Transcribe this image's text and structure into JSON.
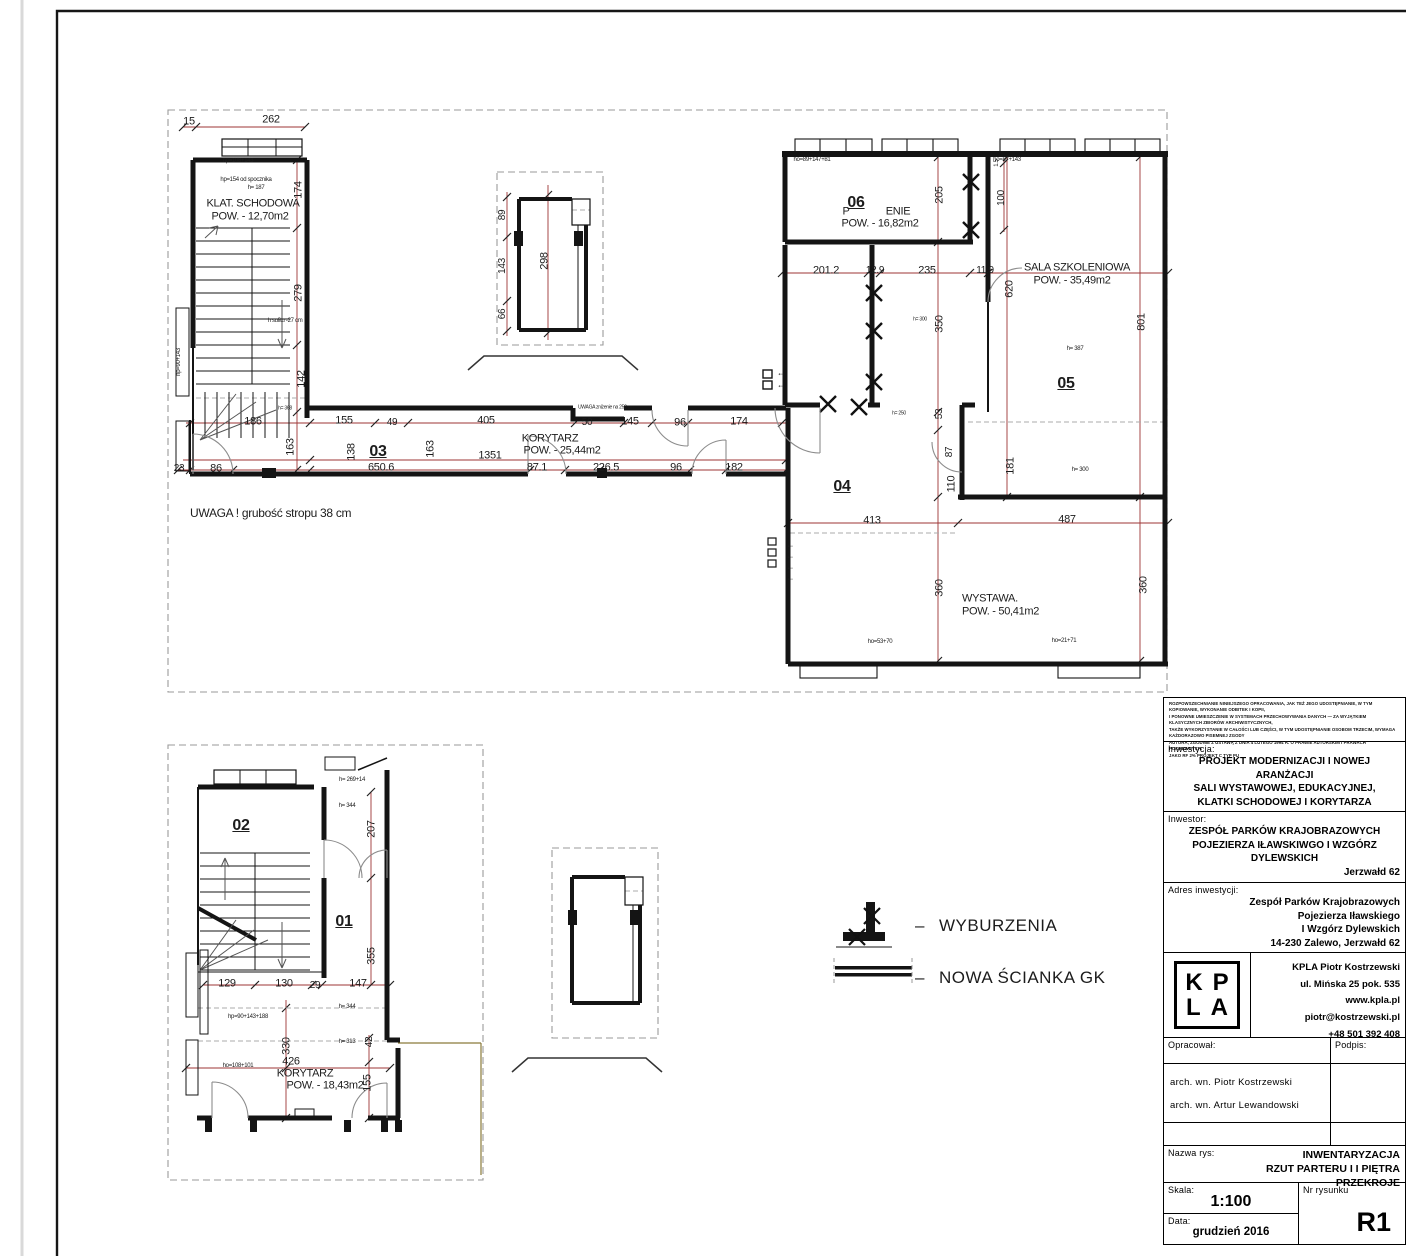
{
  "labels": [
    {
      "t": "15",
      "x": 189,
      "y": 122
    },
    {
      "t": "262",
      "x": 271,
      "y": 120
    },
    {
      "t": "174",
      "x": 299,
      "y": 190,
      "r": 1
    },
    {
      "t": "279",
      "x": 299,
      "y": 293,
      "r": 1
    },
    {
      "t": "142",
      "x": 302,
      "y": 379,
      "r": 1
    },
    {
      "t": "KLAT. SCHODOWA",
      "x": 253,
      "y": 204
    },
    {
      "t": "POW. - 12,70m2",
      "x": 250,
      "y": 217
    },
    {
      "t": "hp=108+143",
      "x": 238,
      "y": 161,
      "s": 6
    },
    {
      "t": "hp=154 od spocznika",
      "x": 246,
      "y": 180,
      "s": 6
    },
    {
      "t": "h= 187",
      "x": 256,
      "y": 188,
      "s": 6
    },
    {
      "t": "h sufitu -27 cm",
      "x": 285,
      "y": 321,
      "s": 6
    },
    {
      "t": "hp=90+143",
      "x": 179,
      "y": 362,
      "s": 6,
      "r": 1
    },
    {
      "t": "h= 368",
      "x": 285,
      "y": 409,
      "s": 5
    },
    {
      "t": "186",
      "x": 253,
      "y": 422
    },
    {
      "t": "155",
      "x": 344,
      "y": 421
    },
    {
      "t": "49",
      "x": 392,
      "y": 423,
      "s": 10
    },
    {
      "t": "405",
      "x": 486,
      "y": 421
    },
    {
      "t": "50",
      "x": 587,
      "y": 423,
      "s": 10
    },
    {
      "t": "145",
      "x": 630,
      "y": 422
    },
    {
      "t": "96",
      "x": 680,
      "y": 423
    },
    {
      "t": "174",
      "x": 739,
      "y": 422
    },
    {
      "t": "UWAGA  zniżenie na 250 cm",
      "x": 578,
      "y": 408,
      "s": 5,
      "al": "left"
    },
    {
      "t": "163",
      "x": 291,
      "y": 447,
      "r": 1
    },
    {
      "t": "138",
      "x": 352,
      "y": 452,
      "r": 1
    },
    {
      "t": "03",
      "x": 378,
      "y": 452,
      "s": 16,
      "w": 1,
      "u": 1
    },
    {
      "t": "650.6",
      "x": 381,
      "y": 468
    },
    {
      "t": "163",
      "x": 431,
      "y": 449,
      "r": 1
    },
    {
      "t": "1351",
      "x": 490,
      "y": 456
    },
    {
      "t": "KORYTARZ",
      "x": 550,
      "y": 439
    },
    {
      "t": "POW. - 25,44m2",
      "x": 562,
      "y": 451
    },
    {
      "t": "87.1",
      "x": 537,
      "y": 468
    },
    {
      "t": "226.5",
      "x": 606,
      "y": 468
    },
    {
      "t": "96",
      "x": 676,
      "y": 468
    },
    {
      "t": "182",
      "x": 734,
      "y": 468
    },
    {
      "t": "23",
      "x": 179,
      "y": 469,
      "s": 10
    },
    {
      "t": "86",
      "x": 216,
      "y": 469
    },
    {
      "t": "06",
      "x": 856,
      "y": 203,
      "s": 16,
      "w": 1,
      "u": 1
    },
    {
      "t": "P",
      "x": 846,
      "y": 212
    },
    {
      "t": "ENIE",
      "x": 898,
      "y": 212
    },
    {
      "t": "POW. - 16,82m2",
      "x": 880,
      "y": 224
    },
    {
      "t": "205",
      "x": 940,
      "y": 195,
      "r": 1
    },
    {
      "t": "1.5",
      "x": 997,
      "y": 163,
      "r": 1,
      "s": 6
    },
    {
      "t": "100",
      "x": 1002,
      "y": 198,
      "r": 1,
      "s": 10
    },
    {
      "t": "ho=89+147+81",
      "x": 812,
      "y": 160,
      "s": 6
    },
    {
      "t": "ho=87+143",
      "x": 1007,
      "y": 160,
      "s": 6
    },
    {
      "t": "201.2",
      "x": 826,
      "y": 271
    },
    {
      "t": "12.9",
      "x": 875,
      "y": 271,
      "s": 10
    },
    {
      "t": "235",
      "x": 927,
      "y": 271
    },
    {
      "t": "11.9",
      "x": 985,
      "y": 271,
      "s": 10
    },
    {
      "t": "620",
      "x": 1010,
      "y": 289,
      "r": 1
    },
    {
      "t": "SALA SZKOLENIOWA",
      "x": 1077,
      "y": 268
    },
    {
      "t": "POW. - 35,49m2",
      "x": 1072,
      "y": 281
    },
    {
      "t": "801",
      "x": 1142,
      "y": 322,
      "r": 1
    },
    {
      "t": "h= 387",
      "x": 1075,
      "y": 349,
      "s": 6
    },
    {
      "t": "05",
      "x": 1066,
      "y": 384,
      "s": 16,
      "w": 1,
      "u": 1
    },
    {
      "t": "350",
      "x": 940,
      "y": 324,
      "r": 1
    },
    {
      "t": "h= 300",
      "x": 920,
      "y": 320,
      "s": 5
    },
    {
      "t": "h= 250",
      "x": 899,
      "y": 414,
      "s": 5
    },
    {
      "t": "53",
      "x": 940,
      "y": 414,
      "r": 1,
      "s": 10
    },
    {
      "t": "87",
      "x": 950,
      "y": 452,
      "r": 1,
      "s": 10
    },
    {
      "t": "110",
      "x": 952,
      "y": 484,
      "r": 1
    },
    {
      "t": "181",
      "x": 1011,
      "y": 466,
      "r": 1
    },
    {
      "t": "h= 300",
      "x": 1080,
      "y": 470,
      "s": 6
    },
    {
      "t": "04",
      "x": 842,
      "y": 487,
      "s": 16,
      "w": 1,
      "u": 1
    },
    {
      "t": "413",
      "x": 872,
      "y": 521
    },
    {
      "t": "487",
      "x": 1067,
      "y": 520
    },
    {
      "t": "360",
      "x": 940,
      "y": 588,
      "r": 1
    },
    {
      "t": "360",
      "x": 1144,
      "y": 585,
      "r": 1
    },
    {
      "t": "WYSTAWA.",
      "x": 962,
      "y": 599,
      "al": "left"
    },
    {
      "t": "POW. - 50,41m2",
      "x": 962,
      "y": 612,
      "al": "left"
    },
    {
      "t": "ho=53+70",
      "x": 880,
      "y": 642,
      "s": 6
    },
    {
      "t": "ho=21+71",
      "x": 1064,
      "y": 641,
      "s": 6
    },
    {
      "t": "UWAGA ! grubość stropu 38 cm",
      "x": 190,
      "y": 513,
      "al": "left",
      "s": 12
    },
    {
      "t": "89",
      "x": 503,
      "y": 215,
      "r": 1,
      "s": 10
    },
    {
      "t": "143",
      "x": 503,
      "y": 266,
      "r": 1,
      "s": 10
    },
    {
      "t": "66",
      "x": 503,
      "y": 314,
      "r": 1,
      "s": 10
    },
    {
      "t": "298",
      "x": 545,
      "y": 261,
      "r": 1
    },
    {
      "t": "02",
      "x": 241,
      "y": 826,
      "s": 16,
      "w": 1,
      "u": 1
    },
    {
      "t": "01",
      "x": 344,
      "y": 922,
      "s": 16,
      "w": 1,
      "u": 1
    },
    {
      "t": "207",
      "x": 372,
      "y": 829,
      "r": 1
    },
    {
      "t": "355",
      "x": 372,
      "y": 956,
      "r": 1
    },
    {
      "t": "129",
      "x": 227,
      "y": 984
    },
    {
      "t": "130",
      "x": 284,
      "y": 984
    },
    {
      "t": "29",
      "x": 315,
      "y": 986,
      "s": 10
    },
    {
      "t": "147",
      "x": 358,
      "y": 984
    },
    {
      "t": "h= 269+14",
      "x": 352,
      "y": 780,
      "s": 6
    },
    {
      "t": "h= 344",
      "x": 347,
      "y": 806,
      "s": 6
    },
    {
      "t": "h= 344",
      "x": 347,
      "y": 1007,
      "s": 6
    },
    {
      "t": "h= 313",
      "x": 347,
      "y": 1042,
      "s": 6
    },
    {
      "t": "hp=90+143+188",
      "x": 248,
      "y": 1017,
      "s": 6
    },
    {
      "t": "ho=108+101",
      "x": 238,
      "y": 1066,
      "s": 6
    },
    {
      "t": "330",
      "x": 287,
      "y": 1046,
      "r": 1
    },
    {
      "t": "42",
      "x": 370,
      "y": 1042,
      "r": 1,
      "s": 10
    },
    {
      "t": "426",
      "x": 291,
      "y": 1062
    },
    {
      "t": "KORYTARZ",
      "x": 305,
      "y": 1074
    },
    {
      "t": "POW. - 18,43m2",
      "x": 325,
      "y": 1086
    },
    {
      "t": "155",
      "x": 368,
      "y": 1083,
      "r": 1
    },
    {
      "t": "←",
      "x": 781,
      "y": 373,
      "s": 9
    },
    {
      "t": "←",
      "x": 781,
      "y": 385,
      "s": 9
    },
    {
      "t": "←",
      "x": 790,
      "y": 545,
      "s": 9
    },
    {
      "t": "←",
      "x": 790,
      "y": 556,
      "s": 9
    },
    {
      "t": "←",
      "x": 790,
      "y": 567,
      "s": 9
    },
    {
      "t": "←",
      "x": 790,
      "y": 578,
      "s": 9
    }
  ],
  "legend": {
    "dash": "–",
    "items": [
      {
        "label": "WYBURZENIA"
      },
      {
        "label": "NOWA ŚCIANKA GK"
      }
    ]
  },
  "titleblock": {
    "disclaimer_lines": [
      "ROZPOWSZECHNIANIE NINIEJSZEGO OPRACOWANIA, JAK TEŻ JEGO UDOSTĘPNIANIE, W TYM KOPIOWANIE, WYKONANIE ODBITEK I KOPII,",
      "I PONOWNE UMIESZCZENIE W SYSTEMACH PRZECHOWYWANIA DANYCH — ZA WYJĄTKIEM KLASYCZNYCH ZBIORÓW ARCHIWISTYCZNYCH,",
      "TAKŻE WYKORZYSTANIE W CAŁOŚCI LUB CZĘŚCI, W TYM UDOSTĘPNIANIE OSOBOM TRZECIM, WYMAGA KAŻDORAZOWO PISEMNEJ ZGODY",
      "AUTORA, ZGODNIE Z USTAWĄ Z DNIA 4 LUTEGO 1994 R. O PRAWIE AUTORSKIM I PRAWACH POKREWNYCH.",
      "JAKO RF 2% PROJEKT C TYP PU"
    ],
    "inwestycja_label": "Inwestycja:",
    "inwestycja_lines": [
      "PROJEKT MODERNIZACJI I NOWEJ ARANŻACJI",
      "SALI WYSTAWOWEJ, EDUKACYJNEJ,",
      "KLATKI SCHODOWEJ I KORYTARZA"
    ],
    "inwestor_label": "Inwestor:",
    "inwestor_lines": [
      "ZESPÓŁ PARKÓW KRAJOBRAZOWYCH",
      "POJEZIERZA IŁAWSKIWGO I WZGÓRZ DYLEWSKICH",
      "Jerzwałd 62"
    ],
    "adres_label": "Adres inwestycji:",
    "adres_lines": [
      "Zespół Parków Krajobrazowych",
      "Pojezierza Iławskiego",
      "I Wzgórz Dylewskich",
      "14-230 Zalewo, Jerzwałd 62"
    ],
    "logo_line1": "KP",
    "logo_line2": "LA",
    "contact_lines": [
      "KPLA Piotr Kostrzewski",
      "ul. Mińska 25 pok. 535",
      "www.kpla.pl",
      "piotr@kostrzewski.pl",
      "+48 501 392 408"
    ],
    "opracowal_label": "Opracował:",
    "podpis_label": "Podpis:",
    "author_lines": [
      "arch. wn. Piotr Kostrzewski",
      "arch. wn. Artur Lewandowski"
    ],
    "nazwa_label": "Nazwa rys:",
    "nazwa_lines": [
      "INWENTARYZACJA",
      "RZUT PARTERU I I PIĘTRA",
      "PRZEKROJE"
    ],
    "skala_label": "Skala:",
    "skala_value": "1:100",
    "nr_label": "Nr rysunku",
    "nr_value": "R1",
    "data_label": "Data:",
    "data_value": "grudzień 2016"
  }
}
